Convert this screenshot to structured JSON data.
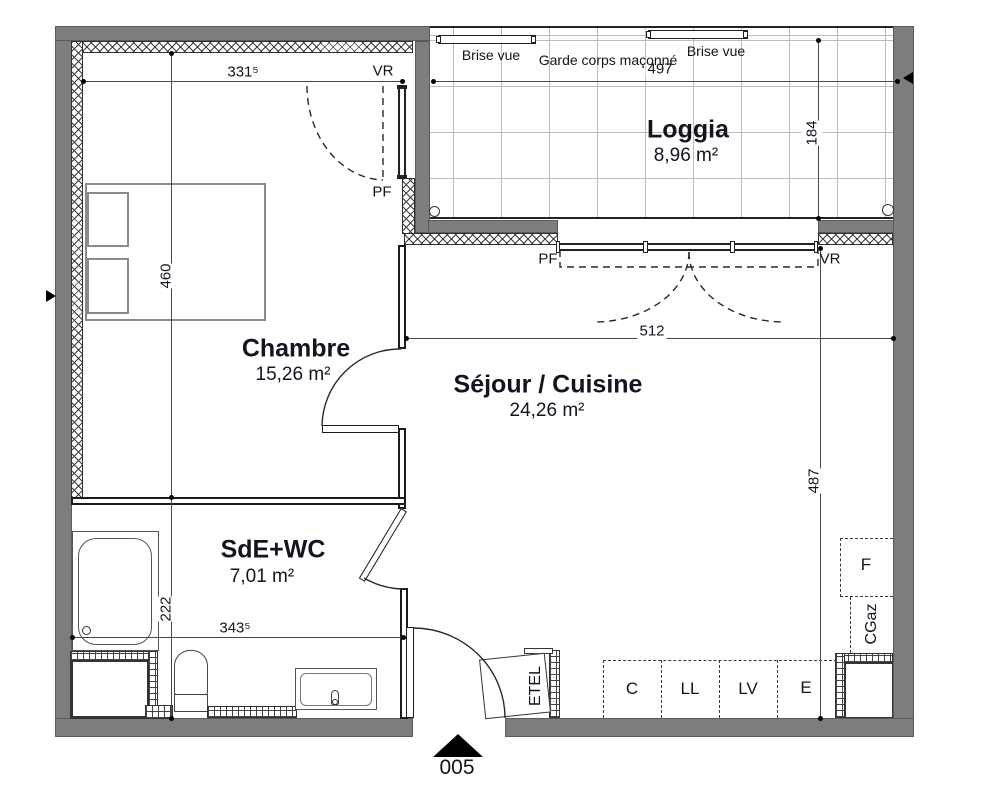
{
  "unit": {
    "number": "005"
  },
  "rooms": {
    "chambre": {
      "name": "Chambre",
      "area": "15,26 m²"
    },
    "sejour": {
      "name": "Séjour / Cuisine",
      "area": "24,26 m²"
    },
    "sde": {
      "name": "SdE+WC",
      "area": "7,01 m²"
    },
    "loggia": {
      "name": "Loggia",
      "area": "8,96 m²"
    }
  },
  "dimensions": {
    "chambre_width": "331⁵",
    "chambre_height": "460",
    "loggia_width": "497",
    "loggia_height": "184",
    "sejour_width": "512",
    "sejour_height": "487",
    "sde_width": "343⁵",
    "sde_height": "222"
  },
  "openings": {
    "vr_chambre": "VR",
    "pf_chambre": "PF",
    "pf_sejour": "PF",
    "vr_sejour": "VR"
  },
  "balcony": {
    "brise_vue_left": "Brise vue",
    "garde_corps": "Garde corps maçonné",
    "brise_vue_right": "Brise vue"
  },
  "equipment": {
    "etel": "ETEL",
    "c": "C",
    "ll": "LL",
    "lv": "LV",
    "e": "E",
    "f": "F",
    "cgaz": "CGaz"
  }
}
